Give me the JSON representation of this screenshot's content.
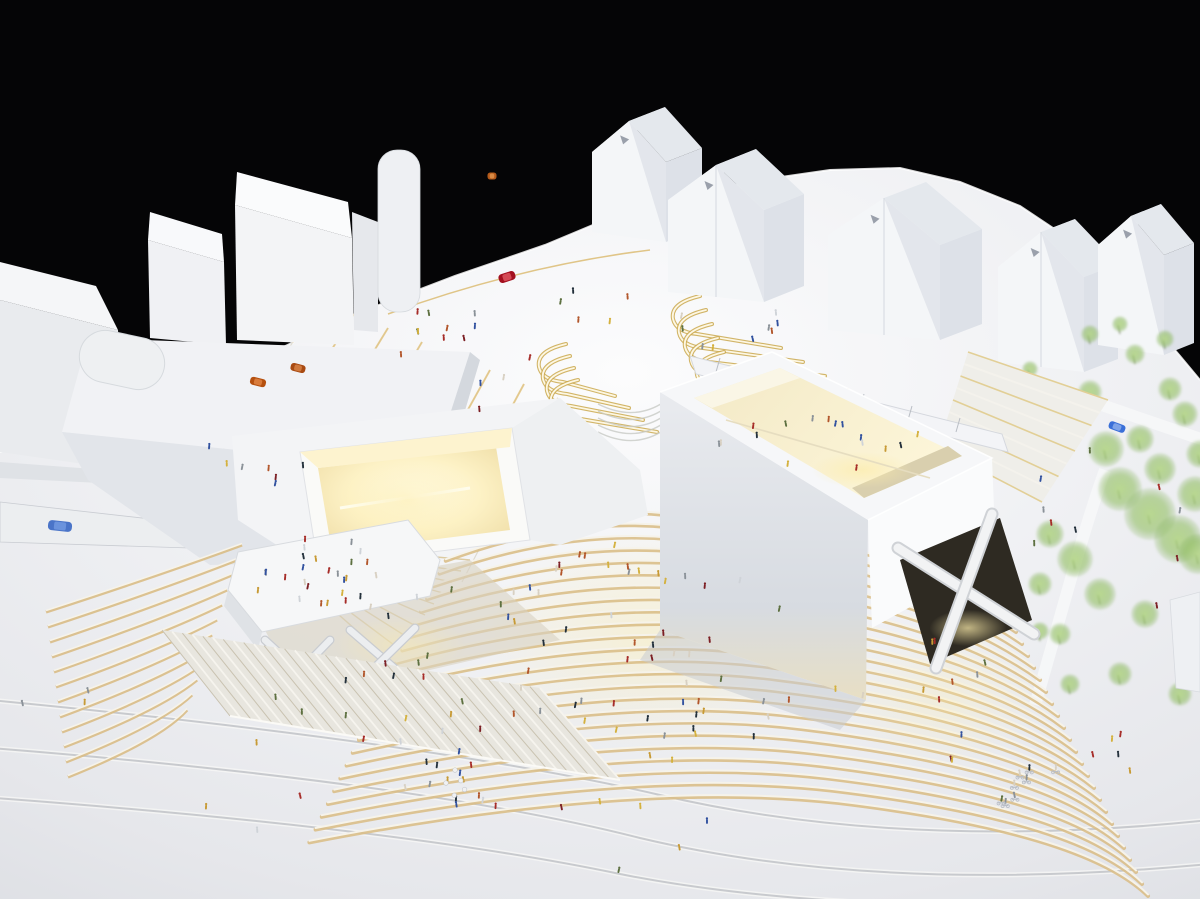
{
  "scene": {
    "background_color": "#050506",
    "colors": {
      "base_center": "#fcfcfd",
      "base_mid": "#eff0f3",
      "base_edge": "#dcdee3",
      "face_light": "#f4f5f7",
      "face_mid": "#e4e7ec",
      "face_dark": "#d3d7dd",
      "warm_glow": "#f9e9b4",
      "warm_deep": "#d9bc7c",
      "warm_bright": "#fff7d6",
      "step_white": "#f6f3ea",
      "step_gold": "#d9bd86",
      "tree_green": "#9cc36f",
      "contour_gray": "#b9bcc2",
      "rim_white": "#ffffff",
      "shadow_cool": "#c9ccd2",
      "dark_void": "#2e2a22"
    },
    "base": {
      "outline": [
        [
          0,
          452
        ],
        [
          120,
          418
        ],
        [
          230,
          372
        ],
        [
          345,
          318
        ],
        [
          455,
          276
        ],
        [
          545,
          245
        ],
        [
          600,
          222
        ],
        [
          648,
          205
        ],
        [
          700,
          192
        ],
        [
          760,
          180
        ],
        [
          830,
          170
        ],
        [
          900,
          168
        ],
        [
          960,
          182
        ],
        [
          1020,
          206
        ],
        [
          1065,
          236
        ],
        [
          1105,
          272
        ],
        [
          1145,
          315
        ],
        [
          1180,
          356
        ],
        [
          1200,
          380
        ],
        [
          1200,
          899
        ],
        [
          0,
          899
        ]
      ]
    },
    "contours": [
      "M -10 700 Q 430 742 660 795 Q 905 852 1210 820",
      "M -10 748 Q 420 782 640 838 Q 880 895 1210 864",
      "M -5 798 Q 400 828 620 874 Q 840 918 1210 902"
    ],
    "pier": {
      "wedge_upper": [
        [
          0,
          462
        ],
        [
          318,
          486
        ],
        [
          322,
          494
        ],
        [
          0,
          478
        ]
      ],
      "wedge_main": [
        [
          0,
          502
        ],
        [
          248,
          530
        ],
        [
          252,
          550
        ],
        [
          0,
          542
        ]
      ],
      "fan_origin": [
        255,
        541
      ],
      "fan_count": 10,
      "bus": {
        "x": 60,
        "y": 526,
        "w": 24,
        "h": 10,
        "angle": 6,
        "color": "#4a74c8",
        "roof": "#6b93dd"
      }
    },
    "plaza": {
      "seam_count": 8,
      "gold_arc": "M 388 314 Q 520 266 650 250",
      "skylight_a": {
        "x": 700,
        "y": 296,
        "count": 5,
        "dx": 6,
        "dy": 14,
        "len0": 84,
        "dlen": 16
      },
      "skylight_b": {
        "x": 566,
        "y": 344,
        "count": 4,
        "dx": 4,
        "dy": 12,
        "len0": 52,
        "dlen": 10
      },
      "amphitheatre": {
        "cx": 634,
        "cy": 404,
        "count": 5,
        "gap": 7
      }
    },
    "topLeftBuildings": {
      "slab_front": [
        [
          0,
          300
        ],
        [
          118,
          330
        ],
        [
          126,
          470
        ],
        [
          0,
          452
        ]
      ],
      "slab_top": [
        [
          0,
          262
        ],
        [
          96,
          286
        ],
        [
          118,
          330
        ],
        [
          0,
          300
        ]
      ],
      "towerA_front": [
        [
          148,
          240
        ],
        [
          224,
          262
        ],
        [
          226,
          345
        ],
        [
          150,
          338
        ]
      ],
      "towerA_top": [
        [
          150,
          212
        ],
        [
          222,
          234
        ],
        [
          224,
          262
        ],
        [
          148,
          240
        ]
      ],
      "towerB_front": [
        [
          235,
          205
        ],
        [
          352,
          238
        ],
        [
          354,
          345
        ],
        [
          237,
          340
        ]
      ],
      "towerB_top": [
        [
          237,
          172
        ],
        [
          348,
          202
        ],
        [
          352,
          238
        ],
        [
          235,
          205
        ]
      ],
      "mid_piece": [
        [
          352,
          212
        ],
        [
          378,
          222
        ],
        [
          378,
          332
        ],
        [
          354,
          330
        ]
      ],
      "cylinder": {
        "x": 378,
        "y": 150,
        "w": 42,
        "h": 162
      },
      "podium_roof": [
        [
          88,
          338
        ],
        [
          470,
          352
        ],
        [
          432,
          470
        ],
        [
          62,
          432
        ]
      ],
      "podium_front": [
        [
          62,
          432
        ],
        [
          432,
          470
        ],
        [
          418,
          560
        ],
        [
          210,
          565
        ],
        [
          88,
          480
        ]
      ],
      "podium_right": [
        [
          432,
          470
        ],
        [
          470,
          352
        ],
        [
          480,
          360
        ],
        [
          445,
          478
        ]
      ],
      "pill": {
        "cx": 122,
        "cy": 360,
        "w": 86,
        "h": 52,
        "angle": 12
      }
    },
    "houses": [
      {
        "x": 592,
        "y": 232,
        "w": 74,
        "h": 80,
        "rh": 36,
        "dx": 36,
        "dy": -14,
        "gables": 1
      },
      {
        "x": 668,
        "y": 292,
        "w": 96,
        "h": 92,
        "rh": 40,
        "dx": 40,
        "dy": -16,
        "gables": 2
      },
      {
        "x": 828,
        "y": 330,
        "w": 112,
        "h": 95,
        "rh": 42,
        "dx": 42,
        "dy": -16,
        "gables": 2
      },
      {
        "x": 998,
        "y": 362,
        "w": 86,
        "h": 95,
        "rh": 40,
        "dx": 34,
        "dy": -13,
        "gables": 2
      },
      {
        "x": 1098,
        "y": 345,
        "w": 66,
        "h": 100,
        "rh": 34,
        "dx": 30,
        "dy": -12,
        "gables": 1
      }
    ],
    "park": {
      "roads": [
        "M 1000 370 C 1060 390 1120 412 1210 442",
        "M 1035 705 C 1060 620 1080 540 1105 470"
      ],
      "trees": [
        [
          1063,
          418,
          16
        ],
        [
          1090,
          398,
          12
        ],
        [
          1106,
          455,
          18
        ],
        [
          1120,
          495,
          22
        ],
        [
          1150,
          520,
          26
        ],
        [
          1178,
          545,
          24
        ],
        [
          1195,
          500,
          18
        ],
        [
          1160,
          475,
          16
        ],
        [
          1140,
          445,
          14
        ],
        [
          1185,
          420,
          13
        ],
        [
          1170,
          395,
          12
        ],
        [
          1198,
          560,
          20
        ],
        [
          1050,
          540,
          14
        ],
        [
          1075,
          565,
          18
        ],
        [
          1040,
          590,
          12
        ],
        [
          1100,
          600,
          16
        ],
        [
          1145,
          620,
          14
        ],
        [
          1190,
          640,
          15
        ],
        [
          1060,
          640,
          11
        ],
        [
          1025,
          470,
          12
        ],
        [
          1008,
          435,
          9
        ],
        [
          990,
          400,
          8
        ],
        [
          1120,
          680,
          12
        ],
        [
          1070,
          690,
          10
        ],
        [
          1180,
          700,
          12
        ],
        [
          1030,
          375,
          8
        ],
        [
          1090,
          340,
          9
        ],
        [
          1135,
          360,
          10
        ],
        [
          1165,
          345,
          9
        ],
        [
          1120,
          330,
          8
        ],
        [
          1200,
          460,
          14
        ],
        [
          1040,
          637,
          9
        ]
      ],
      "car": {
        "x": 1117,
        "y": 427,
        "w": 17,
        "h": 8,
        "angle": 20,
        "color": "#3a6fd8",
        "roof": "#7ea3e8"
      }
    },
    "steps": {
      "left": {
        "count": 12,
        "start": [
          242,
          545
        ],
        "dStart": [
          -5,
          15
        ],
        "ctrl": [
          160,
          575
        ],
        "dCtrl": [
          0,
          15
        ],
        "end": [
          46,
          612
        ],
        "dEnd": [
          2,
          15
        ]
      },
      "center": {
        "count": 24,
        "apex": [
          580,
          497
        ],
        "dApex": [
          2.2,
          12.3
        ],
        "left": [
          452,
          548
        ],
        "dLeft": [
          -6.2,
          12.8
        ],
        "mid": [
          700,
          520
        ],
        "dMid": [
          6,
          12.3
        ],
        "bend": [
          900,
          545
        ],
        "dBend": [
          8,
          12.5
        ],
        "end": [
          1010,
          620
        ],
        "dEnd": [
          6,
          12
        ]
      },
      "ne_quad": [
        [
          968,
          352
        ],
        [
          1108,
          400
        ],
        [
          1042,
          502
        ],
        [
          938,
          448
        ]
      ],
      "ne_count": 9
    },
    "museumLeft": {
      "roof_main": [
        [
          232,
          436
        ],
        [
          560,
          398
        ],
        [
          640,
          470
        ],
        [
          420,
          520
        ],
        [
          300,
          560
        ],
        [
          238,
          520
        ]
      ],
      "east_wing": [
        [
          560,
          398
        ],
        [
          640,
          470
        ],
        [
          648,
          515
        ],
        [
          560,
          545
        ],
        [
          530,
          540
        ],
        [
          512,
          428
        ]
      ],
      "court_outer": [
        [
          300,
          452
        ],
        [
          512,
          428
        ],
        [
          530,
          540
        ],
        [
          318,
          566
        ]
      ],
      "court_floor": [
        [
          318,
          468
        ],
        [
          496,
          447
        ],
        [
          510,
          530
        ],
        [
          332,
          552
        ]
      ],
      "court_wall_n": [
        [
          300,
          452
        ],
        [
          512,
          428
        ],
        [
          510,
          447
        ],
        [
          318,
          468
        ]
      ],
      "terrace": [
        [
          238,
          552
        ],
        [
          408,
          520
        ],
        [
          440,
          560
        ],
        [
          430,
          596
        ],
        [
          262,
          632
        ],
        [
          228,
          590
        ]
      ],
      "terrace_face": [
        [
          228,
          590
        ],
        [
          262,
          632
        ],
        [
          258,
          650
        ],
        [
          224,
          606
        ]
      ],
      "undercroft": [
        [
          250,
          600
        ],
        [
          470,
          560
        ],
        [
          560,
          640
        ],
        [
          300,
          700
        ]
      ],
      "braces": [
        [
          265,
          640,
          330,
          700
        ],
        [
          330,
          640,
          268,
          704
        ],
        [
          350,
          630,
          415,
          686
        ],
        [
          415,
          628,
          352,
          690
        ]
      ],
      "fluted": {
        "top1": [
          162,
          630
        ],
        "top2": [
          540,
          688
        ],
        "bot1": [
          230,
          716
        ],
        "bot2": [
          620,
          780
        ],
        "ribs": 38
      }
    },
    "museumRight": {
      "deck": [
        [
          690,
          356
        ],
        [
          1002,
          434
        ],
        [
          1008,
          452
        ],
        [
          696,
          374
        ]
      ],
      "top_face": [
        [
          660,
          392
        ],
        [
          772,
          352
        ],
        [
          992,
          458
        ],
        [
          868,
          520
        ]
      ],
      "opening": [
        [
          694,
          398
        ],
        [
          780,
          368
        ],
        [
          962,
          456
        ],
        [
          864,
          498
        ]
      ],
      "inner_far": [
        [
          694,
          398
        ],
        [
          780,
          368
        ],
        [
          800,
          378
        ],
        [
          712,
          408
        ]
      ],
      "inner_near": [
        [
          864,
          498
        ],
        [
          962,
          456
        ],
        [
          948,
          446
        ],
        [
          852,
          488
        ]
      ],
      "left_face": [
        [
          660,
          392
        ],
        [
          868,
          520
        ],
        [
          866,
          700
        ],
        [
          660,
          630
        ]
      ],
      "right_face": [
        [
          868,
          520
        ],
        [
          992,
          458
        ],
        [
          996,
          560
        ],
        [
          872,
          628
        ]
      ],
      "base_shadow": [
        [
          660,
          630
        ],
        [
          866,
          700
        ],
        [
          840,
          730
        ],
        [
          640,
          660
        ]
      ],
      "x_opening": [
        [
          900,
          560
        ],
        [
          1000,
          518
        ],
        [
          1032,
          620
        ],
        [
          930,
          664
        ]
      ],
      "x_bars": [
        [
          898,
          548,
          1034,
          634
        ],
        [
          992,
          514,
          936,
          668
        ]
      ],
      "small_cube": [
        [
          1170,
          600
        ],
        [
          1200,
          592
        ],
        [
          1200,
          692
        ],
        [
          1176,
          688
        ]
      ]
    },
    "cars": [
      {
        "name": "orange-car-1",
        "x": 258,
        "y": 382,
        "w": 16,
        "h": 8,
        "angle": 14,
        "color": "#b5500f",
        "roof": "#d97b3a"
      },
      {
        "name": "orange-car-2",
        "x": 298,
        "y": 368,
        "w": 15,
        "h": 8,
        "angle": 14,
        "color": "#a84a12",
        "roof": "#d0793d"
      },
      {
        "name": "orange-car-3",
        "x": 492,
        "y": 176,
        "w": 9,
        "h": 7,
        "angle": 0,
        "color": "#b55a1a",
        "roof": "#d88a45"
      },
      {
        "name": "red-car",
        "x": 507,
        "y": 277,
        "w": 17,
        "h": 9,
        "angle": -18,
        "color": "#a3101f",
        "roof": "#d44a55"
      }
    ],
    "figures": {
      "palette": [
        "#a62c28",
        "#7c1f24",
        "#c79a35",
        "#d4b13e",
        "#31519f",
        "#23303b",
        "#b2562b",
        "#cfd3d8",
        "#8a9198",
        "#5d7040",
        "#d8d0c2"
      ],
      "clusters": [
        {
          "name": "valley-steps",
          "cx": 648,
          "cy": 655,
          "rx": 165,
          "ry": 110,
          "n": 58
        },
        {
          "name": "steps-right-face",
          "cx": 915,
          "cy": 705,
          "rx": 85,
          "ry": 75,
          "n": 12
        },
        {
          "name": "roof-terrace",
          "cx": 318,
          "cy": 578,
          "rx": 80,
          "ry": 40,
          "n": 24
        },
        {
          "name": "below-terrace",
          "cx": 420,
          "cy": 705,
          "rx": 95,
          "ry": 55,
          "n": 14
        },
        {
          "name": "plaza-west",
          "cx": 470,
          "cy": 360,
          "rx": 70,
          "ry": 60,
          "n": 9
        },
        {
          "name": "plaza-north",
          "cx": 730,
          "cy": 325,
          "rx": 60,
          "ry": 30,
          "n": 9
        },
        {
          "name": "interior-ledge",
          "cx": 822,
          "cy": 446,
          "rx": 105,
          "ry": 28,
          "n": 16
        },
        {
          "name": "cafe-group",
          "cx": 452,
          "cy": 788,
          "rx": 55,
          "ry": 35,
          "n": 14
        },
        {
          "name": "south-scatter",
          "cx": 625,
          "cy": 835,
          "rx": 95,
          "ry": 40,
          "n": 6
        },
        {
          "name": "southwest-scatter",
          "cx": 250,
          "cy": 765,
          "rx": 120,
          "ry": 70,
          "n": 7
        },
        {
          "name": "west-edge",
          "cx": 62,
          "cy": 706,
          "rx": 40,
          "ry": 18,
          "n": 3
        },
        {
          "name": "park-figures",
          "cx": 1115,
          "cy": 520,
          "rx": 85,
          "ry": 115,
          "n": 10
        },
        {
          "name": "southeast-plaza",
          "cx": 1115,
          "cy": 762,
          "rx": 70,
          "ry": 40,
          "n": 5
        },
        {
          "name": "north-plaza-edge",
          "cx": 592,
          "cy": 300,
          "rx": 40,
          "ry": 28,
          "n": 5
        },
        {
          "name": "pier-area",
          "cx": 395,
          "cy": 592,
          "rx": 62,
          "ry": 35,
          "n": 6
        },
        {
          "name": "northwest-figures",
          "cx": 250,
          "cy": 462,
          "rx": 55,
          "ry": 30,
          "n": 7
        },
        {
          "name": "top-terrace-north",
          "cx": 448,
          "cy": 330,
          "rx": 40,
          "ry": 25,
          "n": 5
        }
      ],
      "cyclists": {
        "cx": 1032,
        "cy": 776,
        "rx": 40,
        "ry": 30,
        "n": 8,
        "metal": "#b9bec6"
      },
      "cafe_tables": {
        "cx": 452,
        "cy": 782,
        "n": 5,
        "color": "#f0f1f3"
      }
    }
  }
}
